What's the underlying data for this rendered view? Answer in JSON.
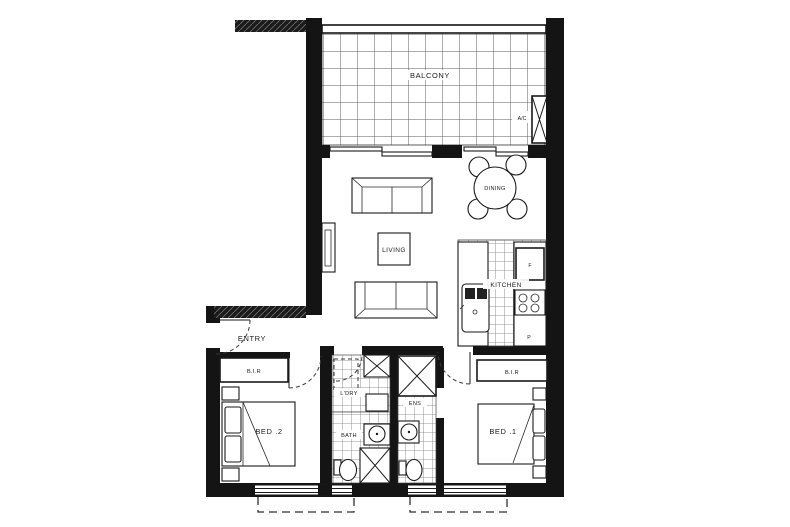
{
  "plan": {
    "rooms": {
      "balcony": "BALCONY",
      "dining": "DINING",
      "living": "LIVING",
      "kitchen": "KITCHEN",
      "entry": "ENTRY",
      "laundry": "L'DRY",
      "bath": "BATH",
      "ensuite": "ENS",
      "bed1": "BED .1",
      "bed2": "BED .2"
    },
    "fixtures": {
      "ac": "A/C",
      "fridge": "F",
      "pantry": "P",
      "robe_bed1": "B.I.R",
      "robe_bed2": "B.I.R"
    },
    "colors": {
      "wall": "#141414",
      "line": "#1a1a1a",
      "tile_line": "#6e6e6e",
      "background": "#ffffff"
    }
  }
}
